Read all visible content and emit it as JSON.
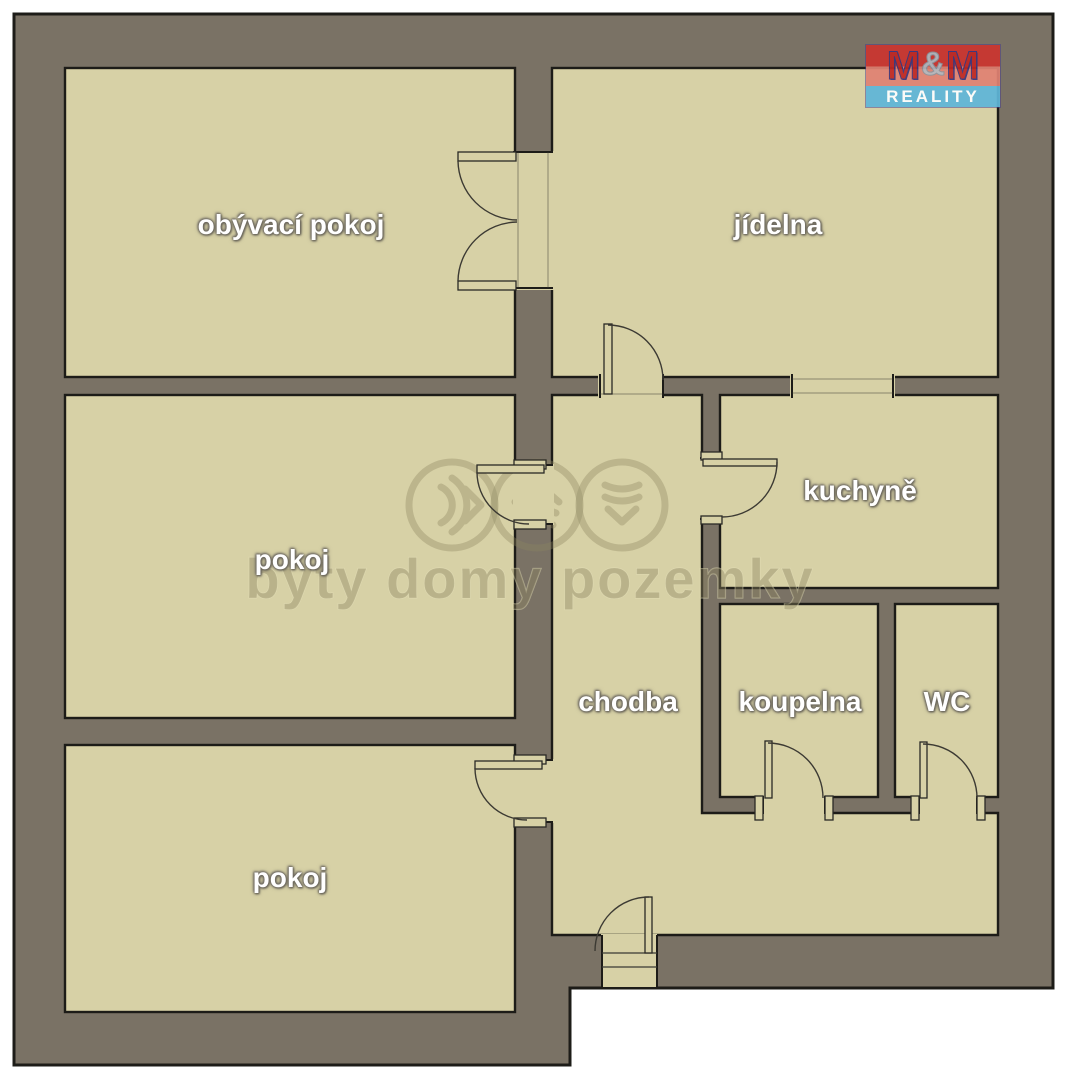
{
  "brand": {
    "logo_top_chars": [
      "M",
      "&",
      "M"
    ],
    "logo_bottom": "REALITY"
  },
  "watermark": {
    "text": "byty domy pozemky"
  },
  "rooms": [
    {
      "label": "obývací pokoj"
    },
    {
      "label": "jídelna"
    },
    {
      "label": "pokoj"
    },
    {
      "label": "kuchyně"
    },
    {
      "label": "chodba"
    },
    {
      "label": "koupelna"
    },
    {
      "label": "WC"
    },
    {
      "label": "pokoj"
    }
  ],
  "colors": {
    "wall": "#7a7265",
    "floor": "#d7d1a6",
    "outline": "#1d1c18",
    "door_line": "#3c3a33",
    "watermark": "#8c8460",
    "logo_red": "#cb3530",
    "logo_red_light": "#e08273",
    "logo_blue": "#5fb6d8",
    "logo_m": "#c02622",
    "logo_amp": "#b4b4bc"
  }
}
